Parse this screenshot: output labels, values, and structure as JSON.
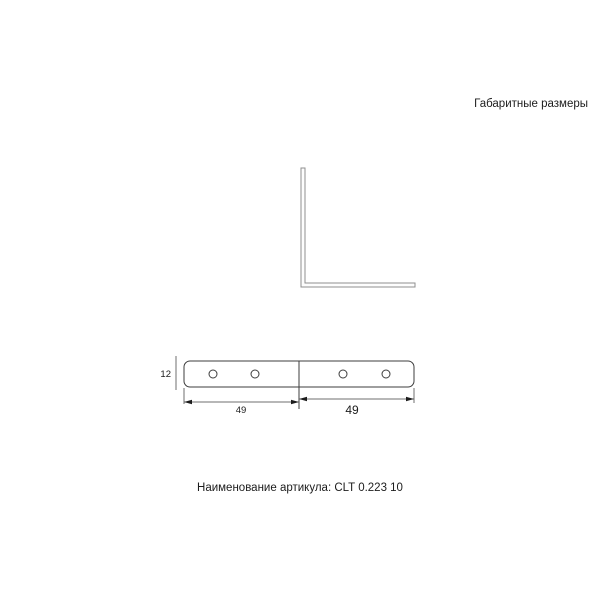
{
  "header": {
    "title": "Габаритные размеры"
  },
  "footer": {
    "article_line": "Наименование артикула: CLT 0.223 10"
  },
  "drawing": {
    "dimensions": {
      "height": "12",
      "width_left": "49",
      "width_right": "49"
    },
    "hole_count": 4
  },
  "colors": {
    "side_view_line": "#8f8f8f",
    "plan_line": "#3d3d3d",
    "dimension_line": "#6f6f6f",
    "arrow": "#1c1c1c",
    "text": "#1c1c1c"
  }
}
